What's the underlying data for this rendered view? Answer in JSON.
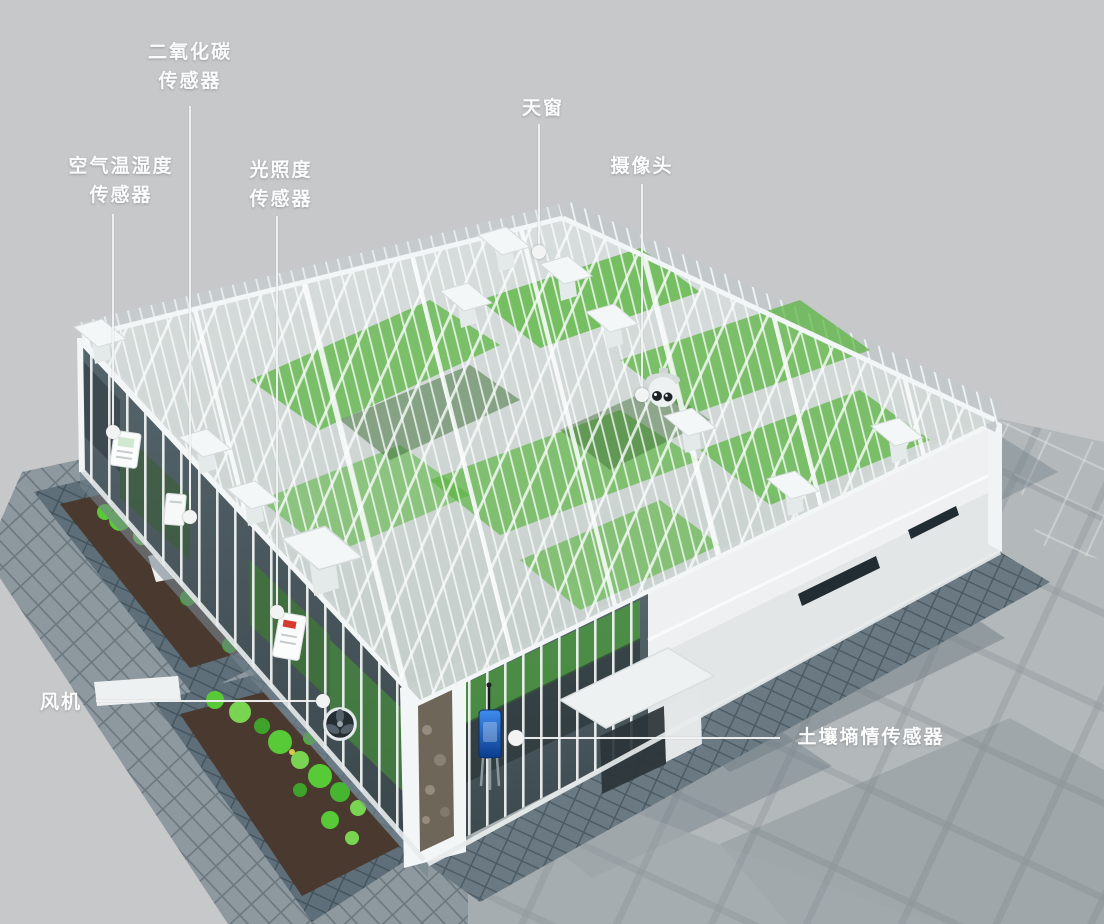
{
  "callouts": {
    "co2": {
      "line1": "二氧化碳",
      "line2": "传感器"
    },
    "air": {
      "line1": "空气温湿度",
      "line2": "传感器"
    },
    "light": {
      "line1": "光照度",
      "line2": "传感器"
    },
    "skylight": {
      "text": "天窗"
    },
    "camera": {
      "text": "摄像头"
    },
    "fan": {
      "text": "风机"
    },
    "soil": {
      "text": "土壤墒情传感器"
    }
  },
  "colors": {
    "bg": "#c6c8c9",
    "white": "#f3f6f7",
    "green": "#56b43a",
    "leaf": "#58c937",
    "leaf2": "#79d551",
    "soil": "#4a392e",
    "stone": "#5e6f7a",
    "plaza": "#b3b8ba",
    "walk": "#8d989f",
    "glass": "#47555b",
    "blue": "#1d6ad1",
    "shadowtile": "#6a7982",
    "callouttext": "#fbfcfc",
    "line": "#f2f4f4"
  }
}
